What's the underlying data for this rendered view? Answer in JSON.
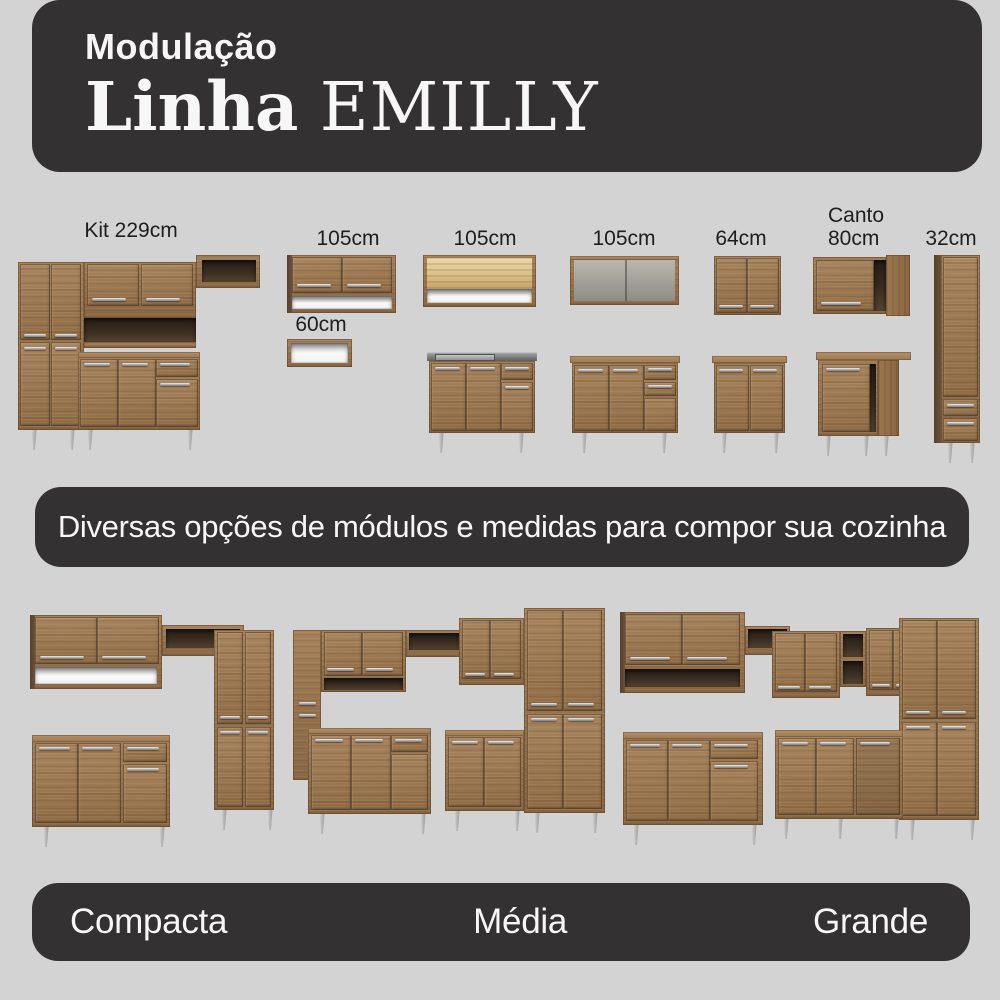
{
  "colors": {
    "background": "#d3d3d4",
    "banner": "#333132",
    "text_light": "#f7f7f7",
    "text_dark": "#1e1e1e",
    "wood": "#96734c"
  },
  "header": {
    "kicker": "Modulação",
    "line_name": "Linha",
    "brand": "EMILLY"
  },
  "module_labels": {
    "kit229": "Kit 229cm",
    "wall105_a": "105cm",
    "niche60": "60cm",
    "wall105_b": "105cm",
    "wall105_c": "105cm",
    "wall64": "64cm",
    "canto80_line1": "Canto",
    "canto80_line2": "80cm",
    "tall32": "32cm"
  },
  "tagline": "Diversas opções de módulos e medidas para compor sua cozinha",
  "kitchen_sizes": {
    "compacta": "Compacta",
    "media": "Média",
    "grande": "Grande"
  }
}
